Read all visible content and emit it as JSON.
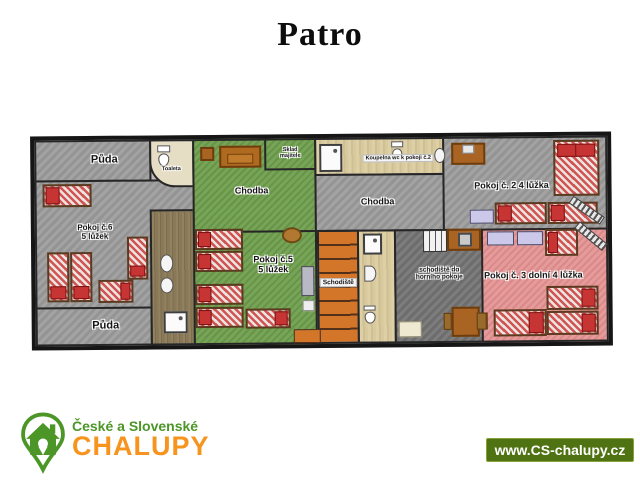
{
  "title": "Patro",
  "plan": {
    "labels": {
      "puda_top": "Půda",
      "toaleta": "Toaleta",
      "pokoj6_name": "Pokoj č.6",
      "pokoj6_beds": "5 lůžek",
      "puda_bottom": "Půda",
      "chodba_left": "Chodba",
      "sklad_line1": "Sklad",
      "sklad_line2": "majitele",
      "pokoj5_name": "Pokoj č.5",
      "pokoj5_beds": "5 lůžek",
      "koupelna": "Koupelna wc k pokoji č.2",
      "chodba_mid": "Chodba",
      "schodiste": "Schodiště",
      "schodiste_horni_line1": "schodiště do",
      "schodiste_horni_line2": "horního pokoje",
      "pokoj2": "Pokoj č. 2 4 lůžka",
      "pokoj3": "Pokoj č. 3 dolní 4 lůžka"
    }
  },
  "footer": {
    "logo_line1": "České a Slovenské",
    "logo_line2": "CHALUPY",
    "website": "www.CS-chalupy.cz"
  },
  "colors": {
    "logo_green": "#4c9628",
    "logo_orange": "#f7941e",
    "banner_green": "#4f7212",
    "room_gray": "#9d9d9d",
    "room_green": "#70a04e",
    "room_pink": "#e49191",
    "stairs_orange": "#d4762a"
  }
}
